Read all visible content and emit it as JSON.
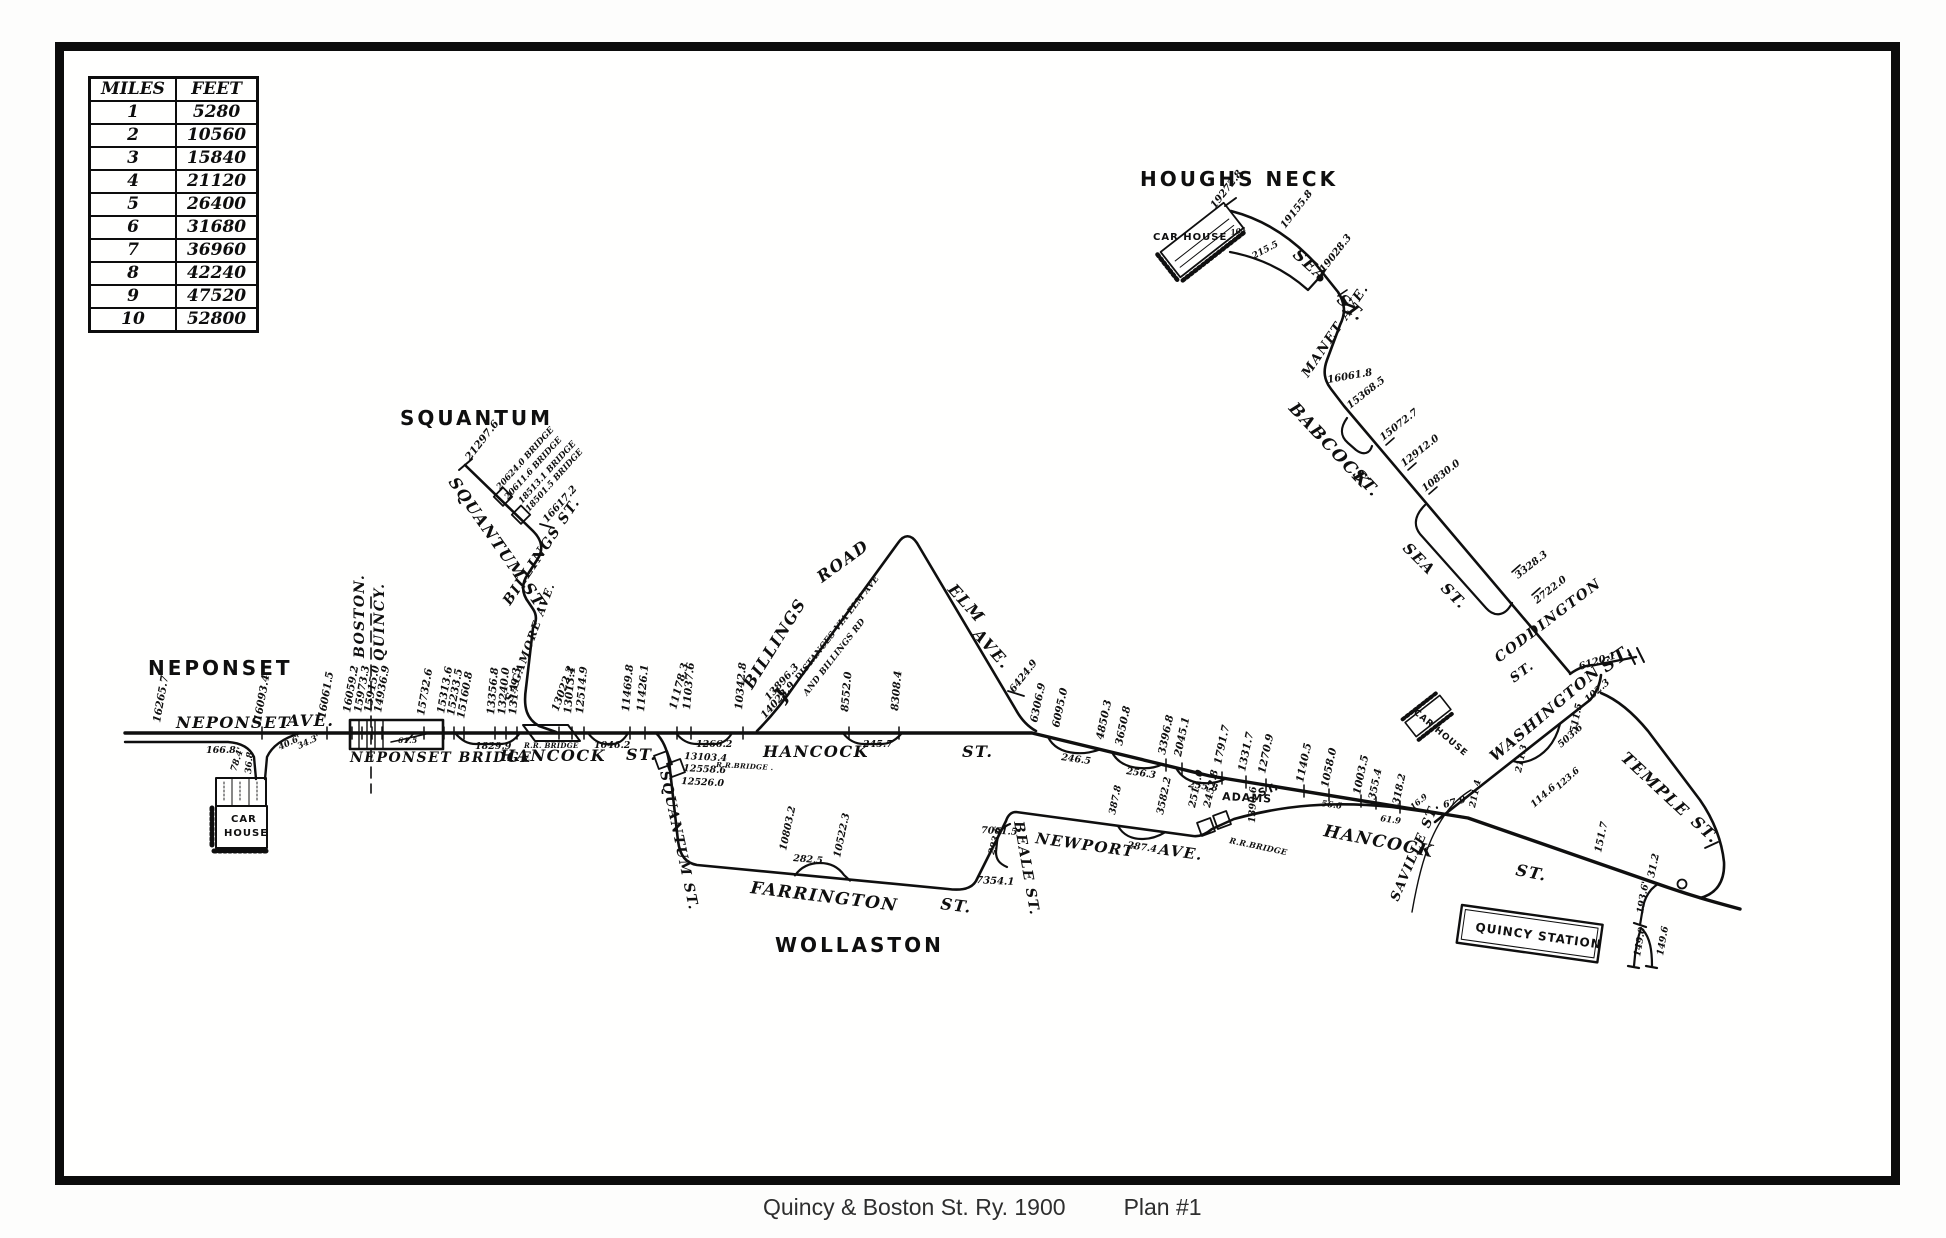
{
  "caption": {
    "text": "Quincy & Boston St. Ry. 1900",
    "plan": "Plan #1"
  },
  "scale_table": {
    "headers": [
      "MILES",
      "FEET"
    ],
    "rows": [
      [
        "1",
        "5280"
      ],
      [
        "2",
        "10560"
      ],
      [
        "3",
        "15840"
      ],
      [
        "4",
        "21120"
      ],
      [
        "5",
        "26400"
      ],
      [
        "6",
        "31680"
      ],
      [
        "7",
        "36960"
      ],
      [
        "8",
        "42240"
      ],
      [
        "9",
        "47520"
      ],
      [
        "10",
        "52800"
      ]
    ]
  },
  "map": {
    "ink_color": "#0f0f0f",
    "places": [
      "NEPONSET",
      "SQUANTUM",
      "WOLLASTON",
      "HOUGHS NECK"
    ],
    "labels": [
      [
        "NEPONSET",
        148,
        675,
        0,
        20,
        "pl"
      ],
      [
        "SQUANTUM",
        400,
        425,
        0,
        20,
        "pl"
      ],
      [
        "WOLLASTON",
        775,
        952,
        0,
        20,
        "pl"
      ],
      [
        "HOUGHS NECK",
        1140,
        186,
        0,
        20,
        "pl"
      ],
      [
        "NEPONSET",
        176,
        728,
        0,
        16,
        "st"
      ],
      [
        "AVE.",
        287,
        726,
        0,
        16,
        "st"
      ],
      [
        "NEPONSET BRIDGE",
        350,
        762,
        0,
        14,
        "st"
      ],
      [
        "BOSTON.",
        364,
        658,
        -90,
        14,
        "st"
      ],
      [
        "QUINCY.",
        384,
        661,
        -90,
        14,
        "st"
      ],
      [
        "CAR",
        231,
        822,
        0,
        10,
        "sm"
      ],
      [
        "HOUSE",
        224,
        836,
        0,
        10,
        "sm"
      ],
      [
        "HANCOCK",
        500,
        761,
        0,
        16,
        "st"
      ],
      [
        "ST.",
        626,
        760,
        0,
        16,
        "st"
      ],
      [
        "R.R. BRIDGE",
        524,
        748,
        0,
        7,
        "tiny"
      ],
      [
        "SQUANTUM ST.",
        448,
        482,
        55,
        16,
        "st"
      ],
      [
        "BILLINGS ST.",
        510,
        606,
        -56,
        14,
        "st"
      ],
      [
        "SAGAMORE AVE.",
        512,
        702,
        -70,
        11,
        "st"
      ],
      [
        "SQUANTUM ST.",
        660,
        772,
        78,
        14,
        "st"
      ],
      [
        "HANCOCK",
        763,
        757,
        0,
        16,
        "st"
      ],
      [
        "ST.",
        962,
        757,
        0,
        16,
        "st"
      ],
      [
        "BILLINGS",
        752,
        690,
        -58,
        16,
        "st"
      ],
      [
        "ROAD",
        822,
        583,
        -36,
        16,
        "st"
      ],
      [
        "ELM",
        947,
        590,
        48,
        16,
        "st"
      ],
      [
        "AVE.",
        972,
        635,
        48,
        16,
        "st"
      ],
      [
        "DISTANCES VIA ELM AVE",
        799,
        681,
        -52,
        8.5,
        "tiny"
      ],
      [
        "AND BILLINGS RD",
        807,
        696,
        -52,
        8.5,
        "tiny"
      ],
      [
        "}",
        783,
        704,
        -52,
        20,
        "st"
      ],
      [
        "FARRINGTON",
        750,
        893,
        7,
        17,
        "st"
      ],
      [
        "ST.",
        940,
        909,
        7,
        16,
        "st"
      ],
      [
        "BEALE ST.",
        1014,
        822,
        80,
        14,
        "st"
      ],
      [
        "NEWPORT",
        1035,
        843,
        8,
        15,
        "st"
      ],
      [
        "AVE.",
        1158,
        854,
        8,
        15,
        "st"
      ],
      [
        "ADAMS",
        1222,
        800,
        3,
        11,
        "sm"
      ],
      [
        "ST.",
        1260,
        797,
        -22,
        11,
        "sm"
      ],
      [
        "R.R.BRIDGE",
        1229,
        843,
        12,
        8,
        "tiny"
      ],
      [
        "HANCOCK",
        1323,
        836,
        11,
        17,
        "st"
      ],
      [
        "ST.",
        1515,
        875,
        11,
        16,
        "st"
      ],
      [
        "SAVILLE ST.",
        1398,
        902,
        -67,
        13,
        "st"
      ],
      [
        "WASHINGTON",
        1495,
        762,
        -40,
        15,
        "st"
      ],
      [
        "CODDINGTON",
        1499,
        663,
        -37,
        14,
        "st"
      ],
      [
        "ST.",
        1514,
        683,
        -37,
        13,
        "st"
      ],
      [
        "ST.",
        1606,
        673,
        -35,
        18,
        "st"
      ],
      [
        "TEMPLE",
        1620,
        759,
        43,
        16,
        "st"
      ],
      [
        "ST.",
        1690,
        823,
        43,
        16,
        "st"
      ],
      [
        "QUINCY STATION",
        1475,
        931,
        8,
        12,
        "sm"
      ],
      [
        "SEA",
        1292,
        256,
        42,
        16,
        "st"
      ],
      [
        "ST.",
        1336,
        301,
        42,
        16,
        "st"
      ],
      [
        "MANET AVE.",
        1308,
        378,
        -56,
        13,
        "st"
      ],
      [
        "BABCOCK",
        1288,
        409,
        47,
        17,
        "st"
      ],
      [
        "ST.",
        1352,
        475,
        47,
        16,
        "st"
      ],
      [
        "SEA",
        1402,
        549,
        45,
        15,
        "st"
      ],
      [
        "ST.",
        1440,
        589,
        45,
        15,
        "st"
      ],
      [
        "CAR HOUSE",
        1153,
        240,
        0,
        10,
        "sm"
      ],
      [
        "CAR HOUSE",
        1413,
        713,
        40,
        9,
        "sm"
      ],
      [
        "16265.7",
        160,
        723,
        -80,
        10.5,
        "num"
      ],
      [
        "166.8",
        206,
        753,
        0,
        9.5,
        "num"
      ],
      [
        "78.4'",
        236,
        772,
        -72,
        9,
        "num"
      ],
      [
        "36.8",
        251,
        774,
        -85,
        9,
        "num"
      ],
      [
        "40.6'",
        280,
        750,
        -25,
        8.5,
        "num"
      ],
      [
        "34.3'",
        299,
        749,
        -25,
        8.5,
        "num"
      ],
      [
        "16093.4",
        261,
        722,
        -80,
        10.5,
        "num"
      ],
      [
        "16061.5",
        325,
        719,
        -80,
        10.5,
        "num"
      ],
      [
        "16059.2",
        350,
        713,
        -80,
        10.5,
        "num"
      ],
      [
        "15973.3",
        361,
        713,
        -80,
        10.5,
        "num"
      ],
      [
        "15915.0",
        371,
        713,
        -80,
        10.5,
        "num"
      ],
      [
        "14936.9",
        381,
        713,
        -80,
        10.5,
        "num"
      ],
      [
        "61.5",
        398,
        743,
        0,
        7.5,
        "tiny"
      ],
      [
        "15732.6",
        424,
        716,
        -80,
        10.5,
        "num"
      ],
      [
        "15313.6",
        444,
        714,
        -80,
        10.5,
        "num"
      ],
      [
        "15233.5",
        454,
        716,
        -80,
        10.5,
        "num"
      ],
      [
        "15160.8",
        464,
        719,
        -80,
        10.5,
        "num"
      ],
      [
        "1829.9",
        475,
        749,
        0,
        9.5,
        "num"
      ],
      [
        "21297.6",
        470,
        461,
        -52,
        10.5,
        "num"
      ],
      [
        "20624.0 BRIDGE",
        500,
        490,
        -48,
        8.5,
        "num"
      ],
      [
        "20611.6 BRIDGE",
        508,
        500,
        -48,
        8.5,
        "num"
      ],
      [
        "18513.1 BRIDGE",
        522,
        504,
        -48,
        8.5,
        "num"
      ],
      [
        "18501.5 BRIDGE",
        529,
        512,
        -48,
        8.5,
        "num"
      ],
      [
        "16617.2",
        547,
        523,
        -48,
        10,
        "num"
      ],
      [
        "13356.8",
        494,
        715,
        -85,
        10.5,
        "num"
      ],
      [
        "13240.0",
        505,
        715,
        -85,
        10.5,
        "num"
      ],
      [
        "13179.3",
        516,
        715,
        -85,
        10.5,
        "num"
      ],
      [
        "13022.2",
        558,
        712,
        -70,
        10.5,
        "num"
      ],
      [
        "13013.1",
        571,
        714,
        -85,
        10.5,
        "num"
      ],
      [
        "12514.9",
        583,
        714,
        -85,
        10.5,
        "num"
      ],
      [
        "1046.2",
        594,
        748,
        0,
        9.5,
        "num"
      ],
      [
        "11469.8",
        629,
        712,
        -85,
        10.5,
        "num"
      ],
      [
        "11426.1",
        644,
        712,
        -85,
        10.5,
        "num"
      ],
      [
        "11178.3",
        676,
        710,
        -75,
        10.5,
        "num"
      ],
      [
        "11037.6",
        690,
        710,
        -85,
        10.5,
        "num"
      ],
      [
        "1266.2",
        696,
        747,
        0,
        9.5,
        "num"
      ],
      [
        "13103.4",
        684,
        759,
        3,
        9.5,
        "num"
      ],
      [
        "12558.6",
        683,
        771,
        3,
        9.5,
        "num"
      ],
      [
        "R.R.BRIDGE .",
        716,
        767,
        3,
        7,
        "tiny"
      ],
      [
        "12526.0",
        681,
        784,
        3,
        9.5,
        "num"
      ],
      [
        "10342.8",
        742,
        710,
        -85,
        10.5,
        "num"
      ],
      [
        "13896.3",
        769,
        701,
        -48,
        10,
        "num"
      ],
      [
        "14023.9",
        765,
        719,
        -48,
        10,
        "num"
      ],
      [
        "8552.0",
        848,
        712,
        -85,
        10.5,
        "num"
      ],
      [
        "8308.4",
        898,
        711,
        -85,
        10.5,
        "num"
      ],
      [
        "245.7",
        863,
        747,
        0,
        9.5,
        "num"
      ],
      [
        "6424.9",
        1014,
        693,
        -52,
        10,
        "num"
      ],
      [
        "6306.9",
        1037,
        723,
        -78,
        10.5,
        "num"
      ],
      [
        "6095.0",
        1059,
        728,
        -78,
        10.5,
        "num"
      ],
      [
        "4850.3",
        1103,
        740,
        -78,
        10.5,
        "num"
      ],
      [
        "3650.8",
        1122,
        746,
        -78,
        10.5,
        "num"
      ],
      [
        "246.5",
        1061,
        760,
        8,
        9.5,
        "num"
      ],
      [
        "256.3",
        1126,
        774,
        8,
        9.5,
        "num"
      ],
      [
        "3396.8",
        1165,
        755,
        -78,
        10.5,
        "num"
      ],
      [
        "2045.1",
        1181,
        757,
        -78,
        10.5,
        "num"
      ],
      [
        "255.8",
        1188,
        787,
        8,
        9.5,
        "num"
      ],
      [
        "1791.7",
        1221,
        765,
        -78,
        10.5,
        "num"
      ],
      [
        "1331.7",
        1245,
        772,
        -78,
        10.5,
        "num"
      ],
      [
        "1270.9",
        1265,
        774,
        -78,
        10.5,
        "num"
      ],
      [
        "1140.5",
        1303,
        783,
        -78,
        10.5,
        "num"
      ],
      [
        "1058.0",
        1328,
        788,
        -78,
        10.5,
        "num"
      ],
      [
        "56.6",
        1321,
        806,
        8,
        8.5,
        "num"
      ],
      [
        "1003.5",
        1360,
        795,
        -78,
        10.5,
        "num"
      ],
      [
        "355.4",
        1375,
        800,
        -78,
        10,
        "num"
      ],
      [
        "318.2",
        1399,
        805,
        -78,
        10,
        "num"
      ],
      [
        "61.9",
        1380,
        821,
        8,
        8.5,
        "num"
      ],
      [
        "16.9",
        1413,
        810,
        -40,
        8,
        "num"
      ],
      [
        "67.9",
        1444,
        808,
        -15,
        9.5,
        "num"
      ],
      [
        "151.7",
        1601,
        853,
        -78,
        10,
        "num"
      ],
      [
        "31.2",
        1654,
        878,
        -78,
        10,
        "num"
      ],
      [
        "193.6'",
        1643,
        914,
        -80,
        9.5,
        "num"
      ],
      [
        "149.0",
        1640,
        957,
        -80,
        9.5,
        "num"
      ],
      [
        "149.6",
        1663,
        956,
        -80,
        9.5,
        "num"
      ],
      [
        "10803.2",
        786,
        851,
        -78,
        10,
        "num"
      ],
      [
        "282.5",
        793,
        861,
        5,
        9.5,
        "num"
      ],
      [
        "10522.3",
        840,
        858,
        -78,
        10,
        "num"
      ],
      [
        "7354.1",
        976,
        883,
        3,
        10,
        "num"
      ],
      [
        "293.6",
        994,
        855,
        -75,
        9,
        "num"
      ],
      [
        "7061.5",
        981,
        833,
        3,
        9.5,
        "num"
      ],
      [
        "387.8",
        1115,
        815,
        -78,
        9.5,
        "num"
      ],
      [
        "287.4",
        1127,
        848,
        8,
        9.5,
        "num"
      ],
      [
        "3582.2",
        1163,
        815,
        -78,
        10,
        "num"
      ],
      [
        "2511.0",
        1195,
        808,
        -78,
        10,
        "num"
      ],
      [
        "2452.8",
        1210,
        808,
        -78,
        10,
        "num"
      ],
      [
        "1390.6",
        1255,
        823,
        -88,
        9.5,
        "num"
      ],
      [
        "211.4",
        1475,
        808,
        -78,
        9,
        "num"
      ],
      [
        "211.3",
        1521,
        773,
        -78,
        9,
        "num"
      ],
      [
        "114.6",
        1534,
        808,
        -42,
        9.5,
        "num"
      ],
      [
        "123.6",
        1559,
        790,
        -42,
        9,
        "num"
      ],
      [
        "503.6",
        1561,
        748,
        -42,
        9.5,
        "num"
      ],
      [
        "511.5",
        1576,
        733,
        -78,
        9.5,
        "num"
      ],
      [
        "102.3",
        1588,
        703,
        -42,
        9.5,
        "num"
      ],
      [
        "6120.1",
        1580,
        670,
        -18,
        10,
        "num"
      ],
      [
        "19272.8",
        1215,
        209,
        -52,
        10,
        "num"
      ],
      [
        "104",
        1231,
        235,
        -10,
        7.5,
        "num"
      ],
      [
        "215.5",
        1254,
        259,
        -28,
        9,
        "num"
      ],
      [
        "19155.8",
        1285,
        229,
        -52,
        10,
        "num"
      ],
      [
        "19028.3",
        1324,
        273,
        -52,
        10,
        "num"
      ],
      [
        "16061.8",
        1328,
        383,
        -10,
        10,
        "num"
      ],
      [
        "15368.5",
        1350,
        409,
        -38,
        10,
        "num"
      ],
      [
        "15072.7",
        1383,
        441,
        -38,
        10,
        "num"
      ],
      [
        "12912.0",
        1404,
        467,
        -38,
        10,
        "num"
      ],
      [
        "10830.0",
        1425,
        492,
        -38,
        10,
        "num"
      ],
      [
        "3328.3",
        1518,
        579,
        -38,
        10,
        "num"
      ],
      [
        "2722.0",
        1537,
        604,
        -38,
        10,
        "num"
      ]
    ]
  }
}
